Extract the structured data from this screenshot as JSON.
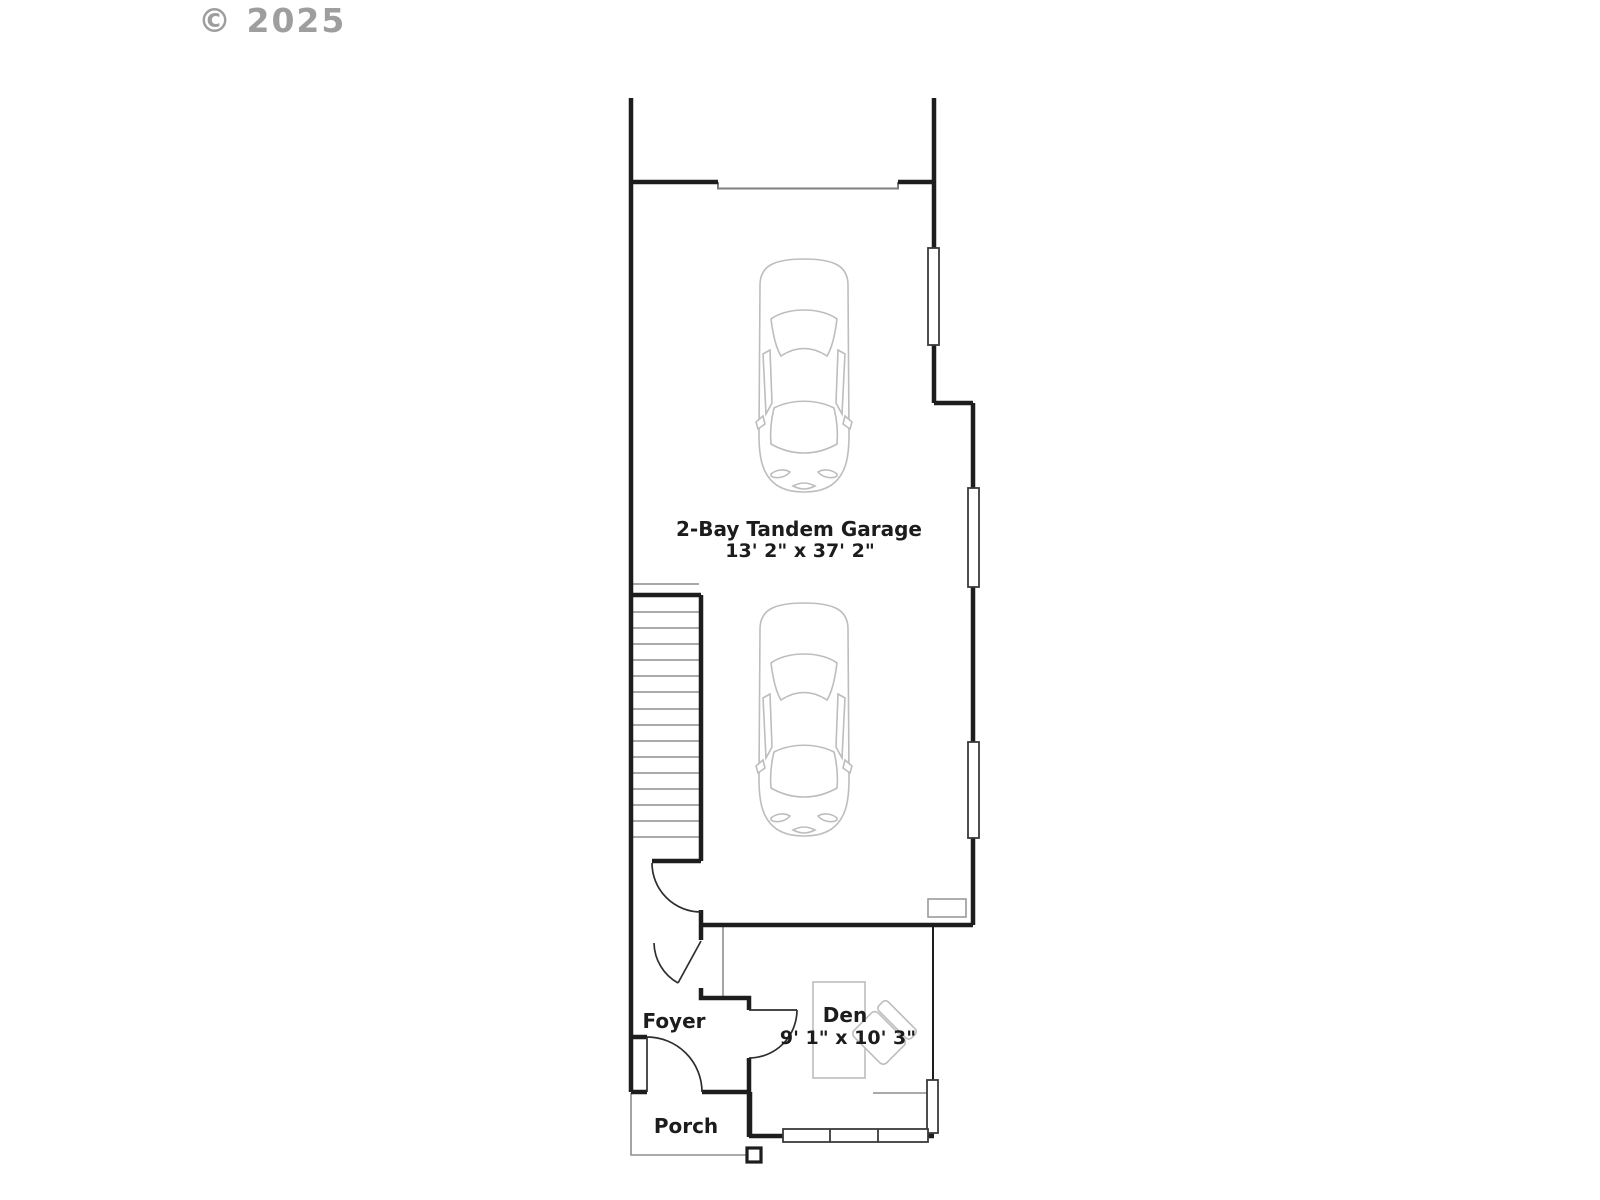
{
  "watermark": {
    "text": "© 2025"
  },
  "plan": {
    "garage": {
      "name": "2-Bay Tandem Garage",
      "dims": "13' 2\" x 37' 2\""
    },
    "den": {
      "name": "Den",
      "dims": "9' 1\" x 10' 3\""
    },
    "foyer": {
      "name": "Foyer"
    },
    "porch": {
      "name": "Porch"
    }
  },
  "colors": {
    "background": "#ffffff",
    "wall": "#1d1d1d",
    "thin_line": "#8e8e8e",
    "door_line": "#2e2e2e",
    "furniture_line": "#bdbdbd",
    "label_text": "#1c1c1c",
    "watermark_text": "#969696"
  }
}
